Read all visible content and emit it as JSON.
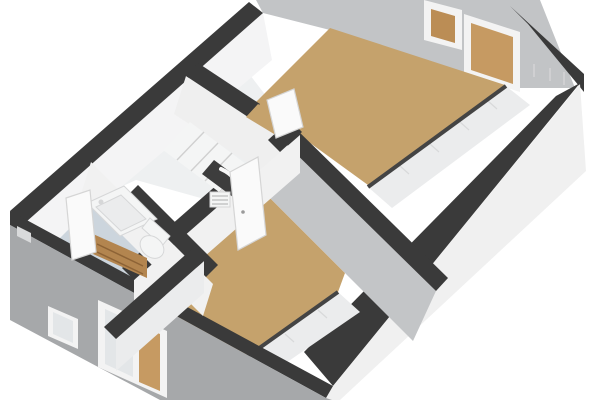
{
  "figure": {
    "type": "3d-floor-plan",
    "view": "isometric-birdseye",
    "background": "#ffffff"
  },
  "rooms": [
    {
      "id": "bedroom-1",
      "position": "top-right",
      "floor": "wood"
    },
    {
      "id": "bedroom-2",
      "position": "bottom-center",
      "floor": "wood"
    },
    {
      "id": "bathroom",
      "position": "left",
      "floor": "blue-tile"
    },
    {
      "id": "landing-hallway",
      "position": "center",
      "floor": "light"
    }
  ],
  "fixtures": [
    "staircase-with-stairwell-opening",
    "vanity-cabinet-with-sink",
    "toilet",
    "radiator-grille",
    "open-door-bathroom",
    "open-door-bedroom-1",
    "open-door-bedroom-2",
    "window-ne-small",
    "window-ne-large",
    "window-sw-bedroom",
    "window-sw-bathroom",
    "window-recess-west"
  ],
  "colors": {
    "page_bg": "#ffffff",
    "wall_top": "#3a3a3a",
    "wall_top_soft": "#444444",
    "nw_face": "#f4f4f5",
    "ne_face": "#c2c4c6",
    "se_outer": "#f0f0f0",
    "sw_outer": "#a6a8aa",
    "inner_white": "#efefef",
    "inner_white2": "#f1f1f1",
    "inner_gray": "#c3c5c7",
    "strip_white": "#ebeced",
    "floor_wood": "#c5a26c",
    "floor_bath": "#ccd5dd",
    "floor_hall": "#eef0f1",
    "window_frame": "#f3f3f3",
    "glass_tan": "#bb8d55",
    "glass_tan_light": "#c69a62",
    "glass_gray": "#e3e6e8",
    "recess_gray": "#d9dadb",
    "wood_front": "#b3854f",
    "wood_side": "#8d6336",
    "wood_line": "#8d6336",
    "fixture_white": "#f4f5f5",
    "fixture_stroke": "#d6d7d8",
    "step_face": "#e2e2e2",
    "step_line": "#d0d0d0",
    "hole_dark": "#3d3d3d",
    "rail_white": "#f8f8f8",
    "tick": "#d8d9da",
    "door_white": "#fafafa",
    "door_stroke": "#d5d5d5",
    "handle_gray": "#9a9a9a",
    "radiator_line": "#b9b9b9"
  }
}
